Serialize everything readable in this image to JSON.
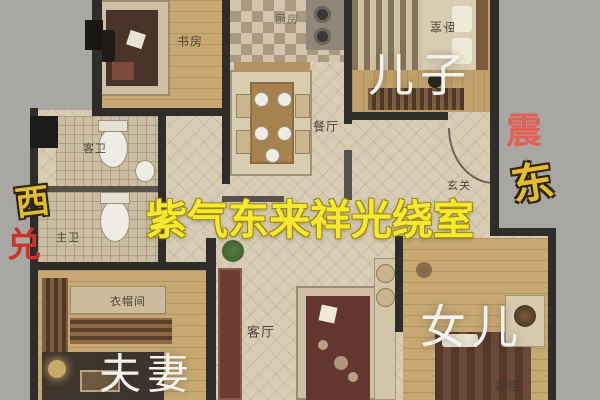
{
  "scene": {
    "description": "3D rendered apartment floor plan photo with feng-shui text overlays",
    "background_color": "#a9a7a4",
    "headline": {
      "text": "紫气东来祥光绕室",
      "color": "#f7e930"
    }
  },
  "overlays": {
    "son": {
      "text": "儿子",
      "color": "#f4f2ee"
    },
    "daughter": {
      "text": "女儿",
      "color": "#f4f2ee"
    },
    "couple": {
      "text": "夫妻",
      "color": "#f4f2ee"
    },
    "west": {
      "text": "西",
      "color": "#e3bf2d"
    },
    "dui": {
      "text": "兑",
      "color": "#c9352a"
    },
    "zhen": {
      "text": "震",
      "color": "#e06155"
    },
    "east": {
      "text": "东",
      "color": "#e3bf2d"
    }
  },
  "rooms": [
    {
      "id": "study",
      "label": "书房"
    },
    {
      "id": "kitchen",
      "label": "厨房"
    },
    {
      "id": "dining",
      "label": "餐厅"
    },
    {
      "id": "bedroom-top",
      "label": "卧室"
    },
    {
      "id": "entry",
      "label": "玄关"
    },
    {
      "id": "guest-bath",
      "label": "客卫"
    },
    {
      "id": "master-bath",
      "label": "主卫"
    },
    {
      "id": "cloakroom",
      "label": "衣帽间"
    },
    {
      "id": "living",
      "label": "客厅"
    },
    {
      "id": "bedroom-bottom",
      "label": "卧室"
    }
  ]
}
